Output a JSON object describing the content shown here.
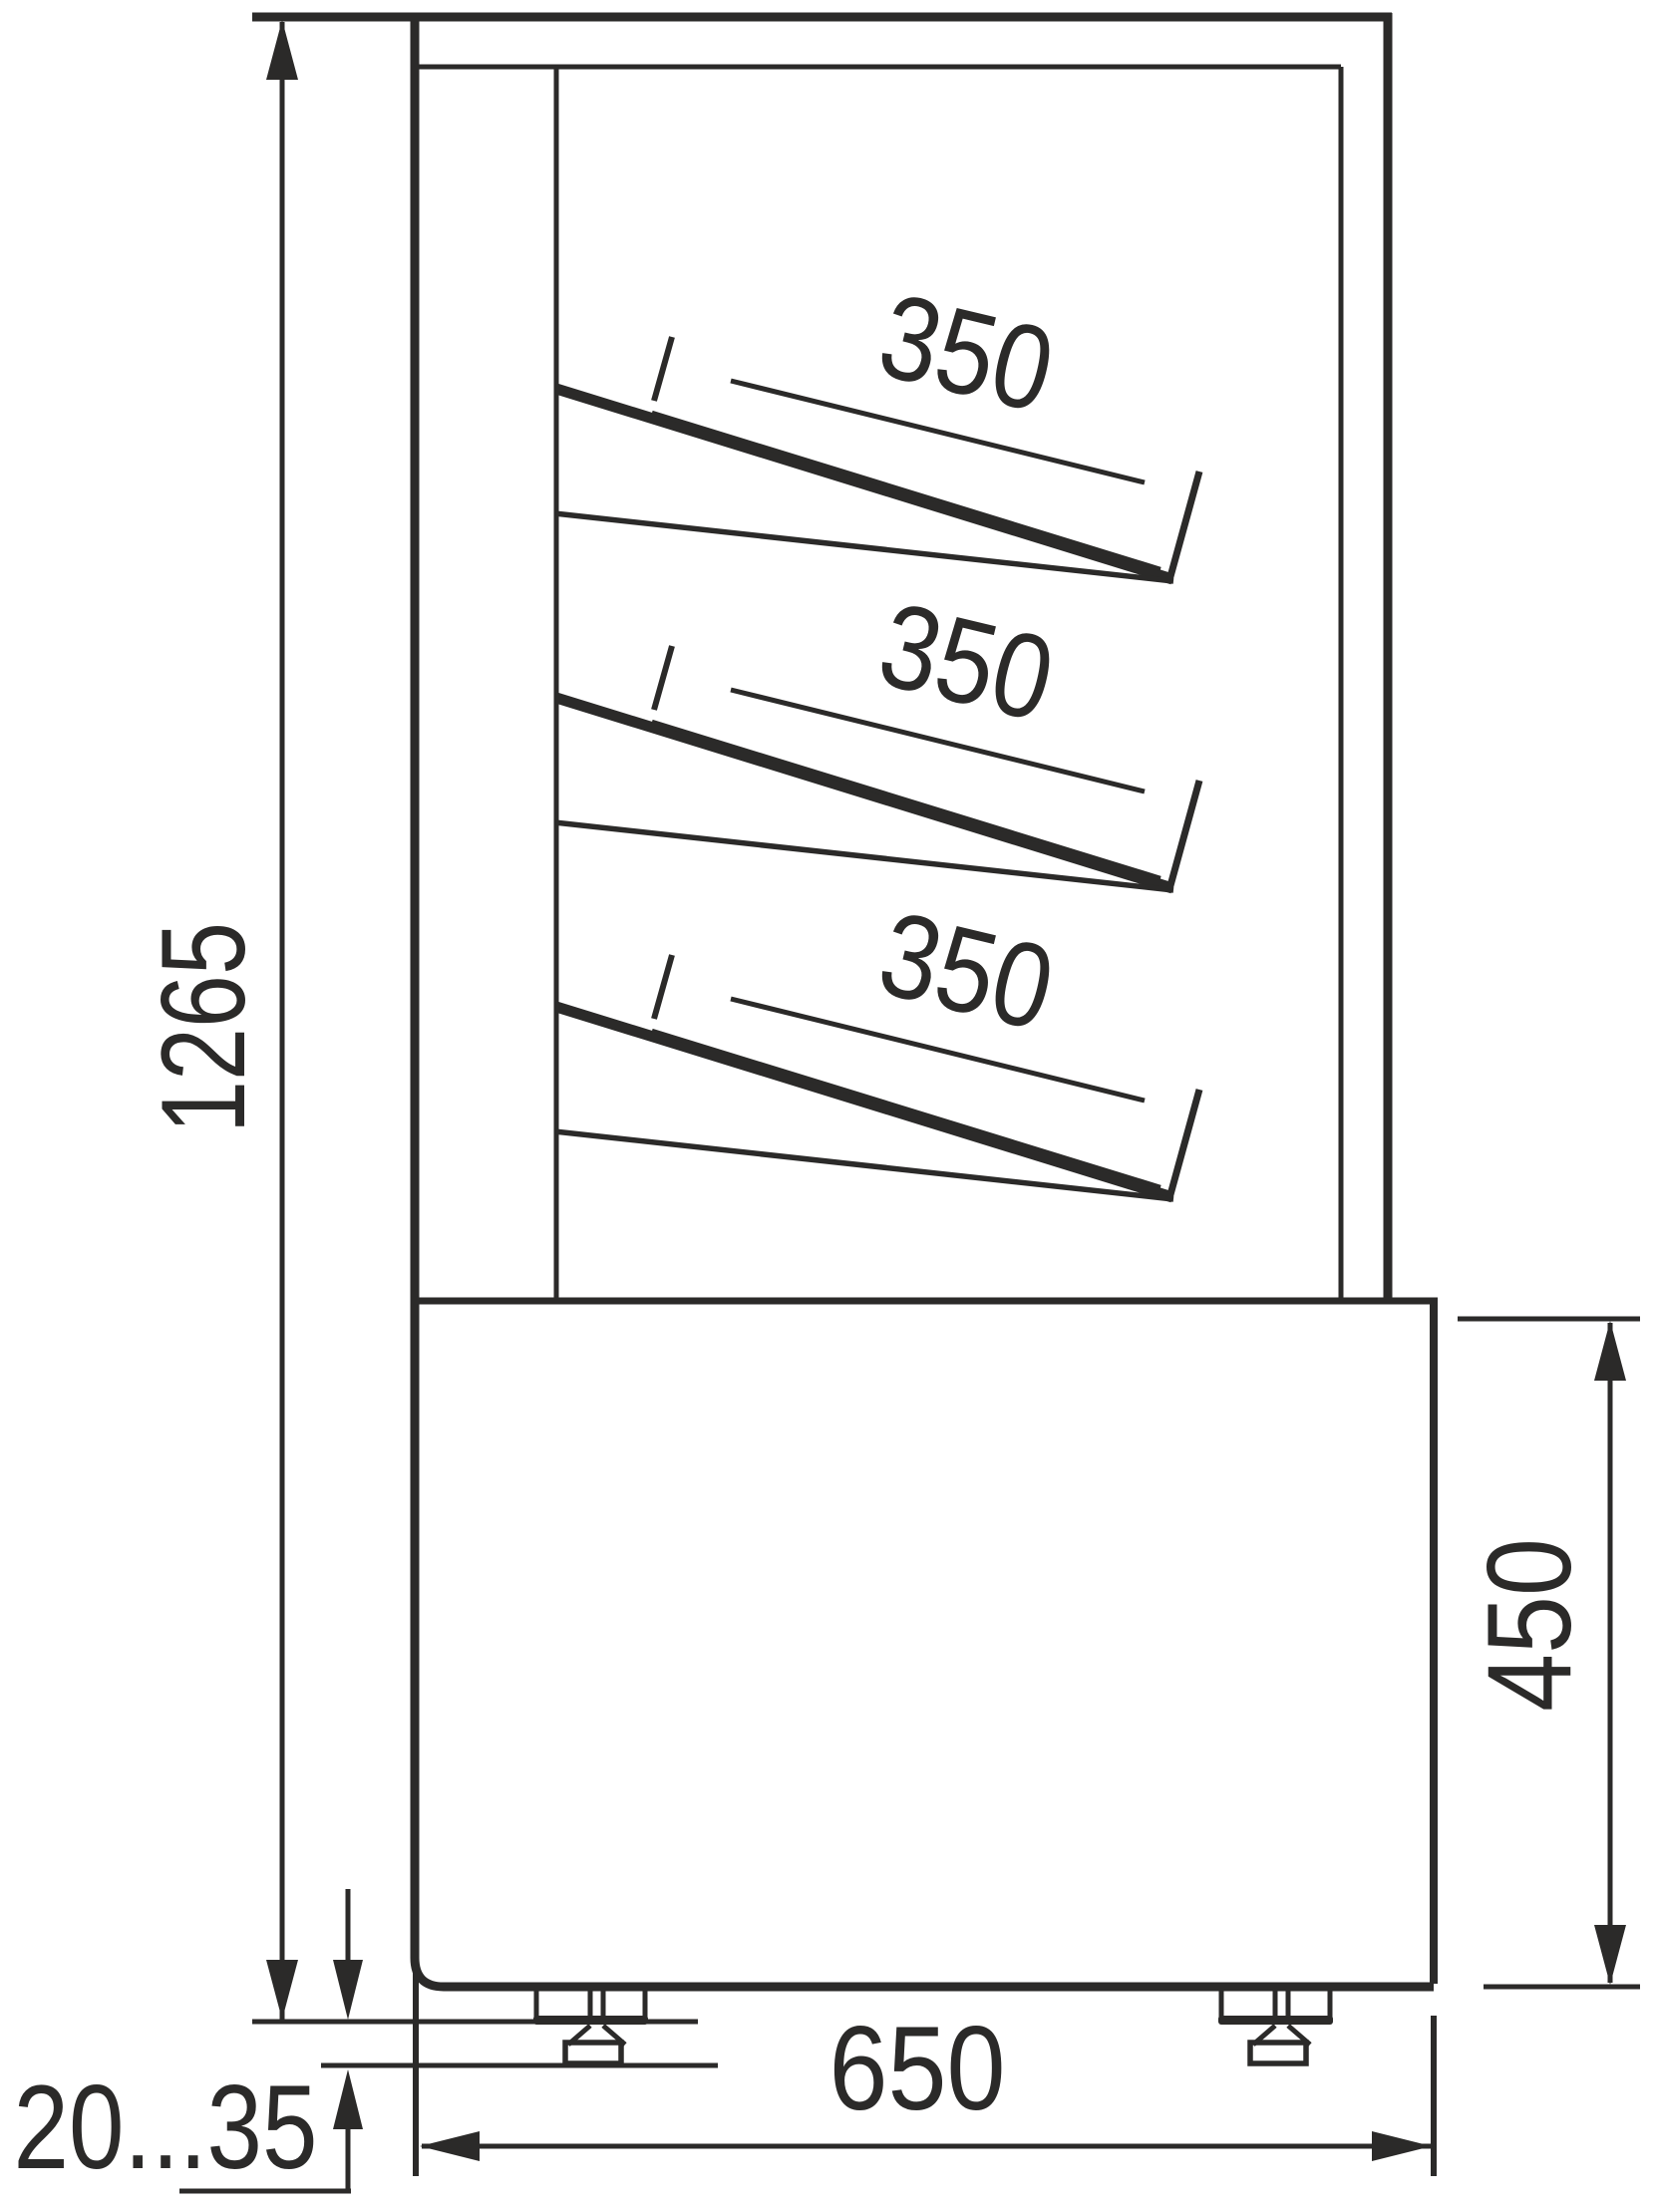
{
  "drawing": {
    "type": "technical-side-view",
    "subject": "refrigerated-display-case-with-slanted-shelves",
    "line_color": "#2b2a29",
    "background_color": "#ffffff",
    "dimensions": {
      "total_height": "1265",
      "base_height": "450",
      "base_depth": "650",
      "foot_adjustment_range": "20...35",
      "shelves": [
        "350",
        "350",
        "350"
      ]
    }
  }
}
